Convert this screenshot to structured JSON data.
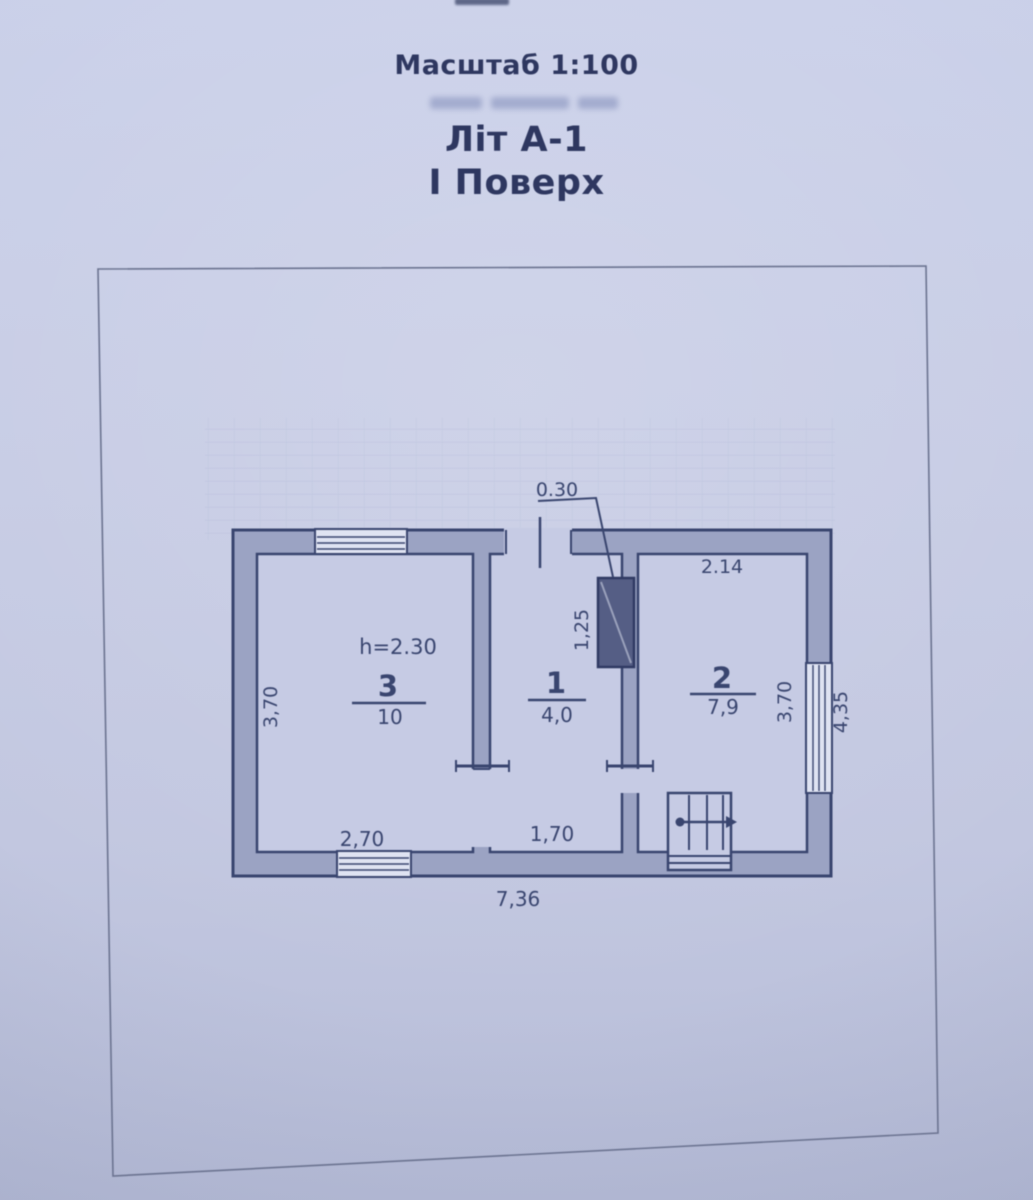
{
  "header": {
    "scale": "Масштаб 1:100",
    "title": "Літ А-1",
    "subtitle": "І Поверх"
  },
  "plan": {
    "rooms": [
      {
        "number": "3",
        "area": "10",
        "ceiling_height": "h=2.30"
      },
      {
        "number": "1",
        "area": "4,0"
      },
      {
        "number": "2",
        "area": "7,9"
      }
    ],
    "dims": {
      "stove_width": "0.30",
      "stove_length": "1,25",
      "room2_top": "2.14",
      "room3_left": "3,70",
      "room2_right": "3,70",
      "right_overall": "4,35",
      "room3_bottom": "2,70",
      "room1_bottom": "1,70",
      "bottom_overall": "7,36"
    }
  },
  "colors": {
    "paper": "#c6cbe4",
    "wall_fill": "#9ba3c3",
    "ink": "#39456f",
    "stove_fill": "#555e85"
  }
}
